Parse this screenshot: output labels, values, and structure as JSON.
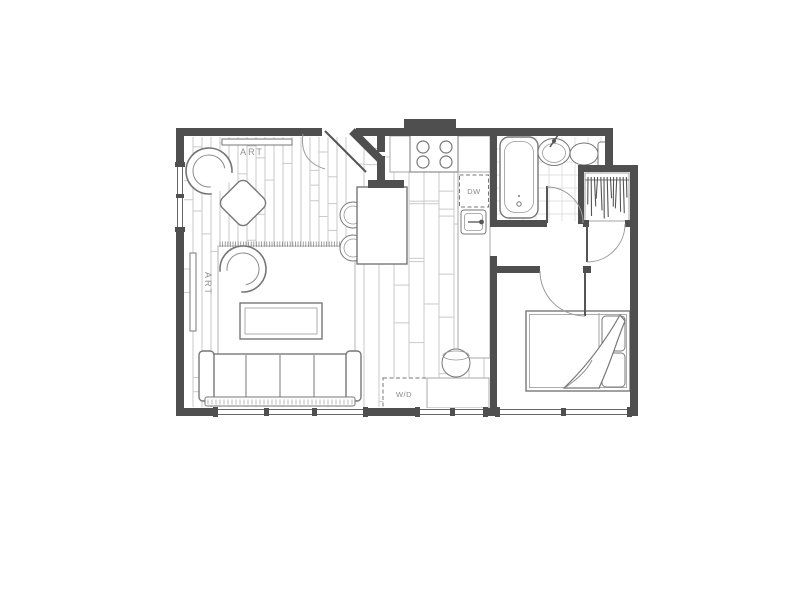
{
  "labels": {
    "art_top": "ART",
    "art_left": "ART",
    "dishwasher": "DW",
    "washer_dryer": "W/D"
  },
  "colors": {
    "bg": "#ffffff",
    "wall": "#4f4f4f",
    "furn": "#777777",
    "light": "#a8a8a8",
    "floor": "#c9c9c9",
    "text": "#8f8f8f"
  }
}
